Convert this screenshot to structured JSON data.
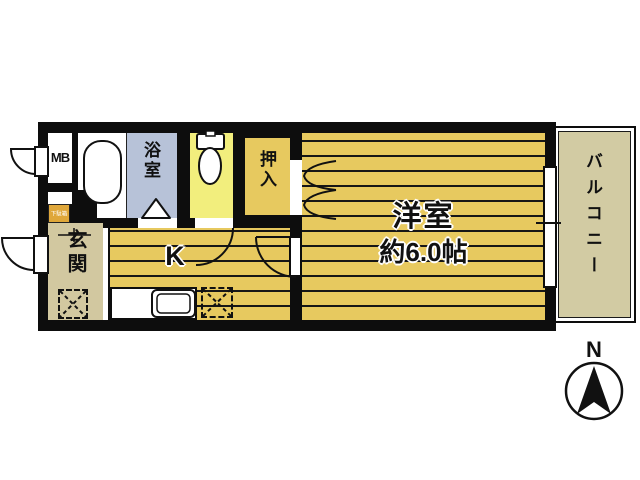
{
  "floor_plan": {
    "rooms": {
      "meter_box": {
        "label": "MB"
      },
      "bathroom": {
        "label": "浴室"
      },
      "closet": {
        "label": "押入"
      },
      "western_room": {
        "label": "洋室",
        "size": "約6.0帖"
      },
      "kitchen": {
        "label": "K"
      },
      "entrance": {
        "label": "玄関"
      },
      "shoe_cabinet": {
        "label": "下駄箱"
      },
      "balcony": {
        "label": "バルコニー"
      }
    },
    "compass": {
      "label": "N"
    },
    "colors": {
      "wall": "#0d0d0d",
      "roomYellow": "#e7c95f",
      "bath": "#b7c2d8",
      "toilet": "#f2ee7d",
      "genkan": "#d2c8a0",
      "balcony": "#d2cba3",
      "shoe": "#dfa73a"
    }
  }
}
